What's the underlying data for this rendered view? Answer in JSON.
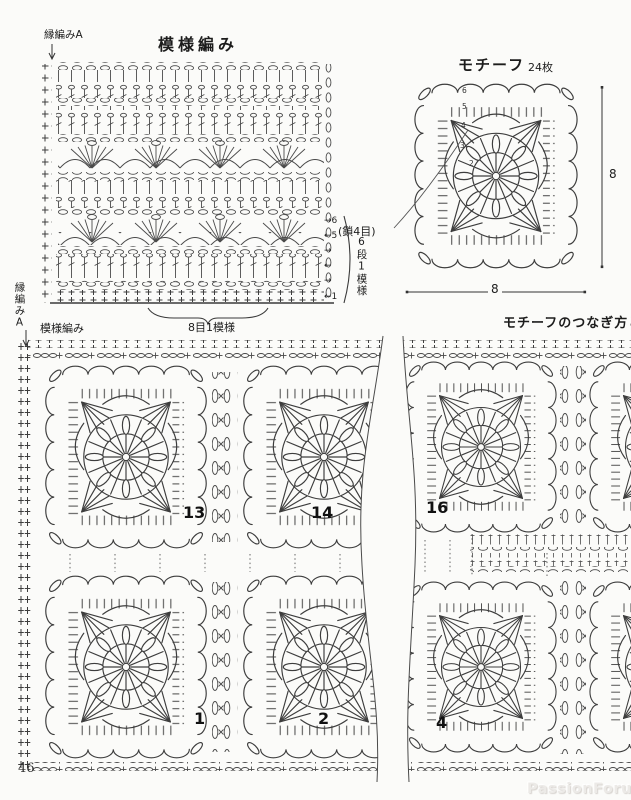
{
  "page": {
    "number": "46",
    "watermark": "PassionForum.ru"
  },
  "icons": {
    "arrow_down": "↓",
    "arrow_right": "→",
    "arrow_left": "←"
  },
  "stitch_chart": {
    "title": "模様編み",
    "edge_label_top": "縁編みA",
    "edge_label_bottom": "縁編みA",
    "base_label": "模様編み",
    "row_bracket_label": "6段1模様",
    "stitch_bracket_label": "8目1模様",
    "row_marks": [
      "→6",
      "←5",
      "→",
      "←",
      "→",
      "←1"
    ]
  },
  "motif": {
    "title": "モチーフ",
    "count_label": "24枚",
    "chain_label": "(鎖4目)",
    "width_label": "8",
    "height_label": "8",
    "round_numbers": [
      "2",
      "3",
      "4",
      "5",
      "6"
    ]
  },
  "assembly": {
    "title": "モチーフのつなぎ方と",
    "motif_numbers": [
      "13",
      "14",
      "16",
      "1",
      "2",
      "4"
    ]
  }
}
